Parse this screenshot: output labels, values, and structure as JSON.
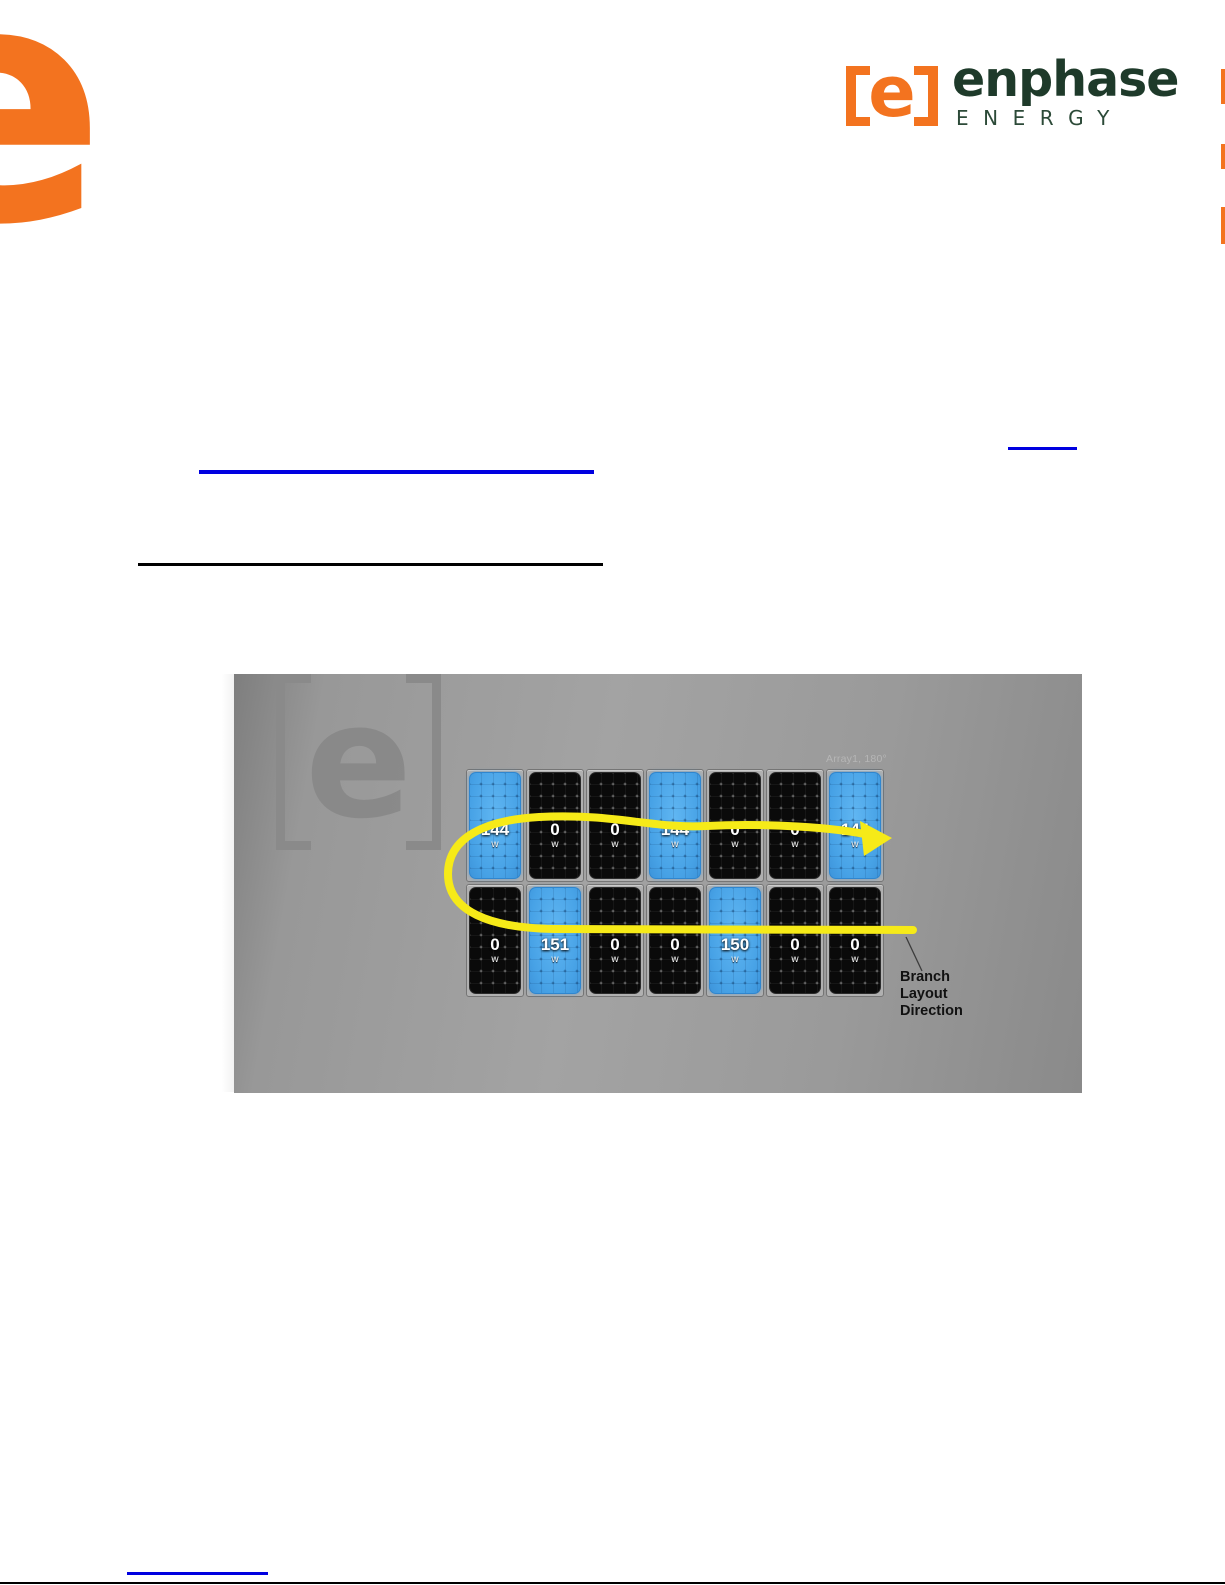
{
  "document": {
    "header": {
      "corner_mark_letter": "e",
      "brand": {
        "mark_letter": "e",
        "name": "enphase",
        "tagline": "ENERGY"
      },
      "icons": {
        "corner_mark": "partial-orange-e",
        "brand_mark": "orange-bracketed-e",
        "edge_tabs": "orange-edge-bars"
      }
    },
    "colors": {
      "brand_orange": "#f3731f",
      "brand_green": "#1e3a2a",
      "link_blue": "#0000e0",
      "arrow_yellow": "#f6ea18",
      "panel_blue": "#4da8ea",
      "panel_black": "#0a0a0a",
      "screenshot_gray": "#999999"
    },
    "figure": {
      "watermark_letter": "e",
      "array_label": "Array1, 180°",
      "annotation_lines": [
        "Branch",
        "Layout",
        "Direction"
      ],
      "panel_rows": [
        {
          "panels": [
            {
              "value": "144",
              "unit": "w",
              "state": "blue"
            },
            {
              "value": "0",
              "unit": "w",
              "state": "black"
            },
            {
              "value": "0",
              "unit": "w",
              "state": "black"
            },
            {
              "value": "144",
              "unit": "w",
              "state": "blue"
            },
            {
              "value": "0",
              "unit": "w",
              "state": "black"
            },
            {
              "value": "0",
              "unit": "w",
              "state": "black"
            },
            {
              "value": "144",
              "unit": "w",
              "state": "blue"
            }
          ]
        },
        {
          "panels": [
            {
              "value": "0",
              "unit": "w",
              "state": "black"
            },
            {
              "value": "151",
              "unit": "w",
              "state": "blue"
            },
            {
              "value": "0",
              "unit": "w",
              "state": "black"
            },
            {
              "value": "0",
              "unit": "w",
              "state": "black"
            },
            {
              "value": "150",
              "unit": "w",
              "state": "blue"
            },
            {
              "value": "0",
              "unit": "w",
              "state": "black"
            },
            {
              "value": "0",
              "unit": "w",
              "state": "black"
            }
          ]
        }
      ]
    }
  }
}
